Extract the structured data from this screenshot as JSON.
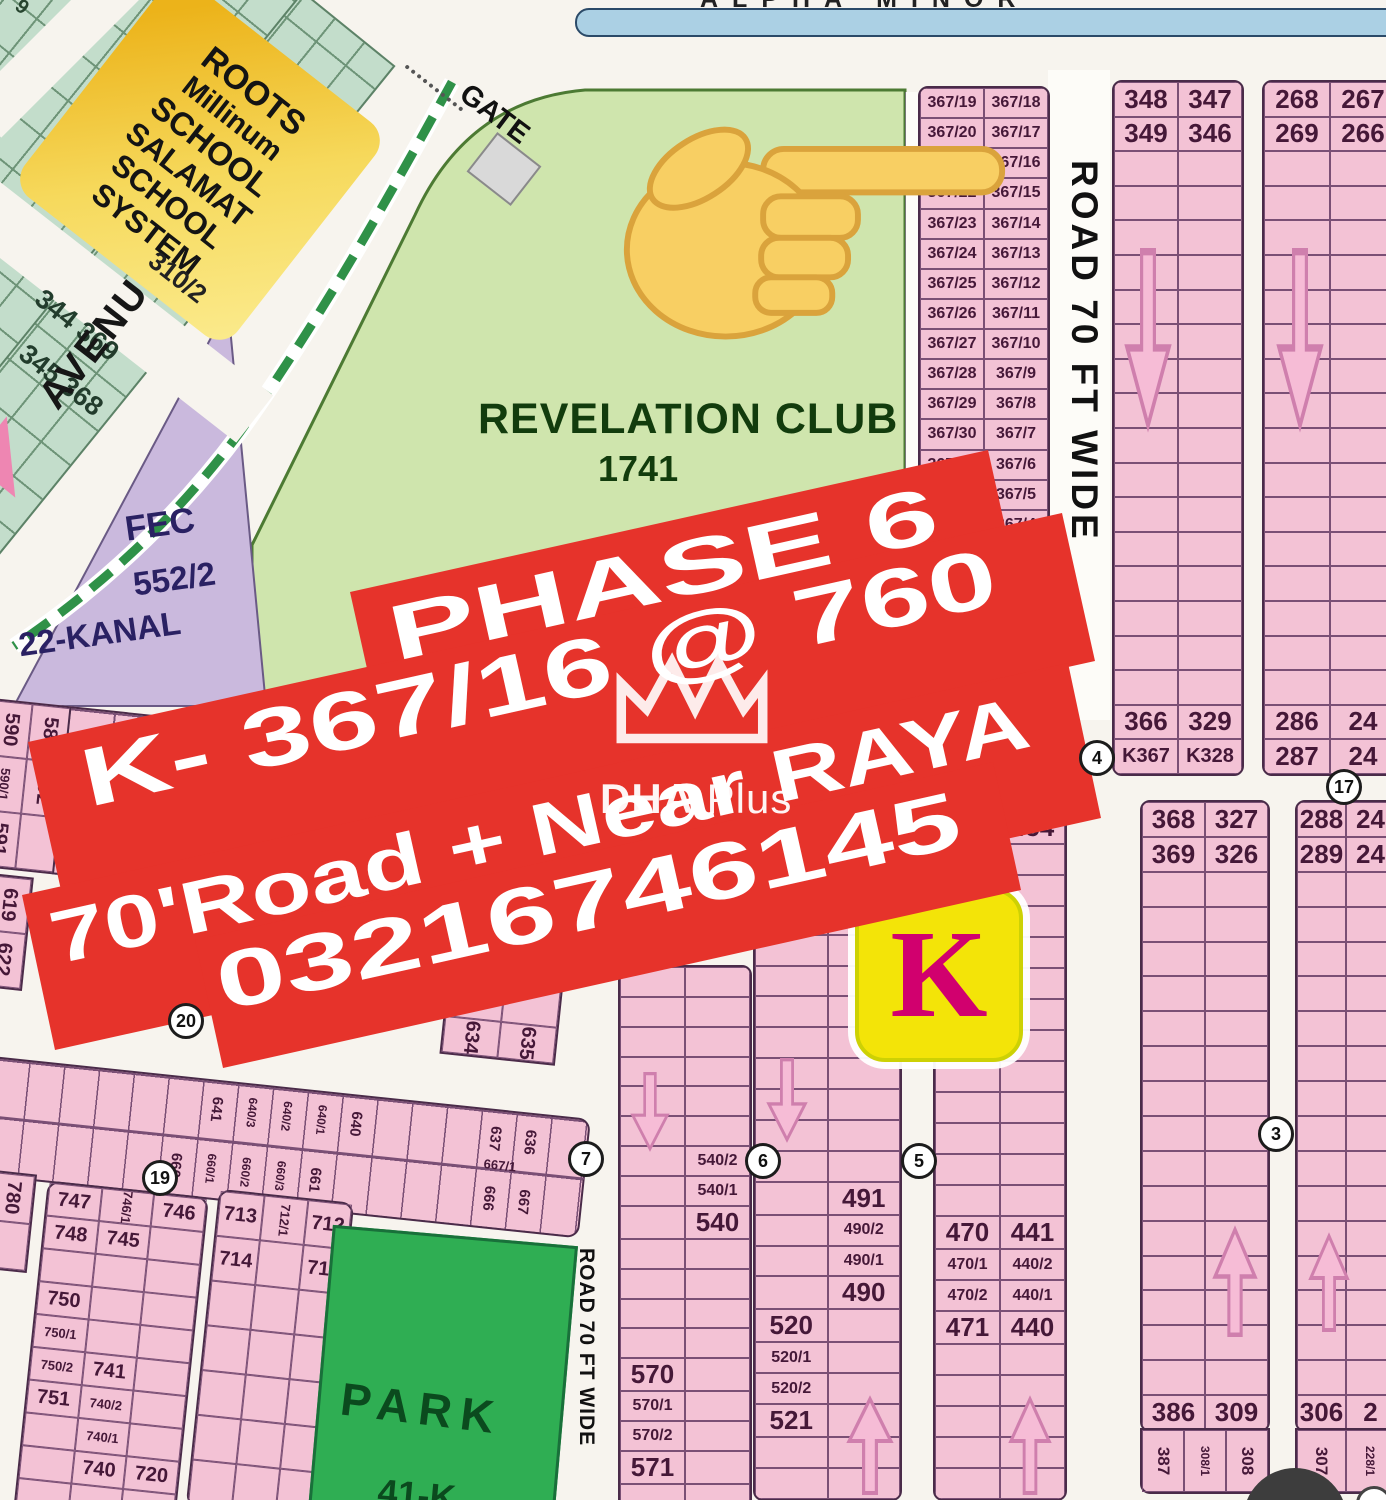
{
  "canal": {
    "label_fragment": "ALPHA MINOR"
  },
  "school": {
    "l1": "ROOTS",
    "l2": "Millinum",
    "l3": "SCHOOL",
    "l4": "SALAMAT",
    "l5": "SCHOOL",
    "l6": "SYSTEM",
    "plot": "310/2"
  },
  "mint": {
    "corner": "9",
    "pair1": "344 369",
    "pair2": "345 368"
  },
  "avenue": {
    "label": "AVENUE - 2"
  },
  "gate": {
    "label": "GATE"
  },
  "club": {
    "name": "REVELATION CLUB",
    "number": "1741"
  },
  "fec": {
    "l1": "FEC",
    "l2": "552/2",
    "l3": "22-KANAL"
  },
  "roads": {
    "r50": "ROAD 50' WIDE",
    "r70a": "ROAD 70 FT WIDE",
    "r70b": "ROAD 70 FT WIDE"
  },
  "banner": {
    "l1": "PHASE 6",
    "l2": "K- 367/16 @ 760",
    "l3": "70'Road + Near RAYA",
    "l4": "03216746145",
    "color": "#e6332b"
  },
  "watermark": {
    "bold": "DHA",
    "rest": ".Plus"
  },
  "klogo": {
    "letter": "K"
  },
  "park": {
    "name": "PARK",
    "size": "41-K"
  },
  "circles": {
    "c3": "3",
    "c4": "4",
    "c5": "5",
    "c6": "6",
    "c7": "7",
    "c17": "17",
    "c19": "19",
    "c20": "20"
  },
  "grids": {
    "g367": {
      "rows": [
        [
          "367/19",
          "367/18"
        ],
        [
          "367/20",
          "367/17"
        ],
        [
          "367/21",
          "367/16"
        ],
        [
          "367/22",
          "367/15"
        ],
        [
          "367/23",
          "367/14"
        ],
        [
          "367/24",
          "367/13"
        ],
        [
          "367/25",
          "367/12"
        ],
        [
          "367/26",
          "367/11"
        ],
        [
          "367/27",
          "367/10"
        ],
        [
          "367/28",
          "367/9"
        ],
        [
          "367/29",
          "367/8"
        ],
        [
          "367/30",
          "367/7"
        ],
        [
          "367/31",
          "367/6"
        ],
        [
          "367/32",
          "367/5"
        ],
        [
          "367/33",
          "367/4"
        ],
        [
          "367/34",
          "367/3"
        ],
        [
          "367/35",
          ""
        ]
      ]
    },
    "gA": {
      "rows": [
        [
          "348",
          "347"
        ],
        [
          "349",
          "346"
        ],
        null,
        null,
        null,
        null,
        null,
        null,
        null,
        null,
        null,
        null,
        null,
        null,
        null,
        null,
        null,
        null,
        [
          "366",
          "329"
        ],
        [
          "K367",
          "K328"
        ]
      ]
    },
    "gB": {
      "rows": [
        [
          "268",
          "267"
        ],
        [
          "269",
          "266"
        ],
        null,
        null,
        null,
        null,
        null,
        null,
        null,
        null,
        null,
        null,
        null,
        null,
        null,
        null,
        null,
        null,
        [
          "286",
          "24"
        ],
        [
          "287",
          "24"
        ]
      ]
    },
    "gC": {
      "rows": [
        [
          "368",
          "327"
        ],
        [
          "369",
          "326"
        ],
        null,
        null,
        null,
        null,
        null,
        null,
        null,
        null,
        null,
        null,
        null,
        null,
        null,
        null,
        null,
        [
          "386",
          "309"
        ]
      ]
    },
    "gD": {
      "rows": [
        [
          "288",
          "24"
        ],
        [
          "289",
          "24"
        ],
        null,
        null,
        null,
        null,
        null,
        null,
        null,
        null,
        null,
        null,
        null,
        null,
        null,
        null,
        null,
        [
          "306",
          "2"
        ]
      ]
    },
    "gE": {
      "rows": [
        null,
        [
          "456",
          "455"
        ],
        [
          "457",
          "454"
        ],
        null,
        null,
        null,
        null,
        null,
        null,
        null,
        null,
        null,
        null,
        null,
        null,
        [
          "470",
          "441"
        ],
        [
          "470/1",
          "440/2"
        ],
        [
          "470/2",
          "440/1"
        ],
        [
          "471",
          "440"
        ],
        null,
        null,
        null,
        null,
        null
      ]
    },
    "gF": {
      "rows": [
        null,
        null,
        null,
        null,
        null,
        null,
        null,
        null,
        null,
        null,
        null,
        [
          "",
          "491"
        ],
        [
          "",
          "490/2"
        ],
        [
          "",
          "490/1"
        ],
        [
          "",
          "490"
        ],
        [
          "520",
          ""
        ],
        [
          "520/1",
          ""
        ],
        [
          "520/2",
          ""
        ],
        [
          "521",
          ""
        ],
        null,
        null
      ]
    },
    "gG": {
      "rows": [
        null,
        null,
        null,
        null,
        null,
        null,
        [
          "",
          "540/2"
        ],
        [
          "",
          "540/1"
        ],
        [
          "",
          "540"
        ],
        null,
        null,
        null,
        null,
        [
          "570",
          ""
        ],
        [
          "570/1",
          ""
        ],
        [
          "570/2",
          ""
        ],
        [
          "571",
          ""
        ],
        null
      ]
    }
  },
  "bottoms": {
    "gC": [
      "387",
      "308/1",
      "308"
    ],
    "gD": [
      "307",
      "228/1",
      ""
    ]
  },
  "mats": {
    "mK1": {
      "cols": 3,
      "cells": [
        "747",
        "746/1|v",
        "746",
        "748",
        "745",
        "",
        "",
        "",
        "",
        "750",
        "",
        "",
        "750/1",
        "",
        "",
        "750/2",
        "741",
        "",
        "751",
        "740/2",
        "",
        "",
        "740/1",
        "",
        "",
        "740",
        "720",
        "",
        "",
        "720/1"
      ]
    },
    "mK2": {
      "cols": 3,
      "cells": [
        "713",
        "712/1|v",
        "712",
        "714",
        "",
        "711",
        "",
        "",
        "",
        "",
        "",
        "",
        "",
        "",
        "",
        "",
        "",
        "",
        "",
        "",
        ""
      ]
    },
    "mH634": {
      "cols": 2,
      "cells": [
        "",
        "",
        "",
        "",
        "634|v",
        "635|v"
      ]
    },
    "mI589": {
      "cols": 2,
      "cells": [
        "590|v",
        "589|v",
        "590/1|v",
        "592|v",
        "591|v",
        ""
      ]
    },
    "m619": {
      "cols": 1,
      "cells": [
        "619|v",
        "622|v"
      ]
    },
    "m780": {
      "cols": 1,
      "cells": [
        "780|v",
        ""
      ]
    }
  },
  "b640": {
    "labels": [
      "641",
      "640/3",
      "640/2",
      "640/1",
      "640",
      "637",
      "636",
      "660",
      "660/1",
      "660/2",
      "660/3",
      "661",
      "666",
      "667",
      "667/1"
    ]
  }
}
